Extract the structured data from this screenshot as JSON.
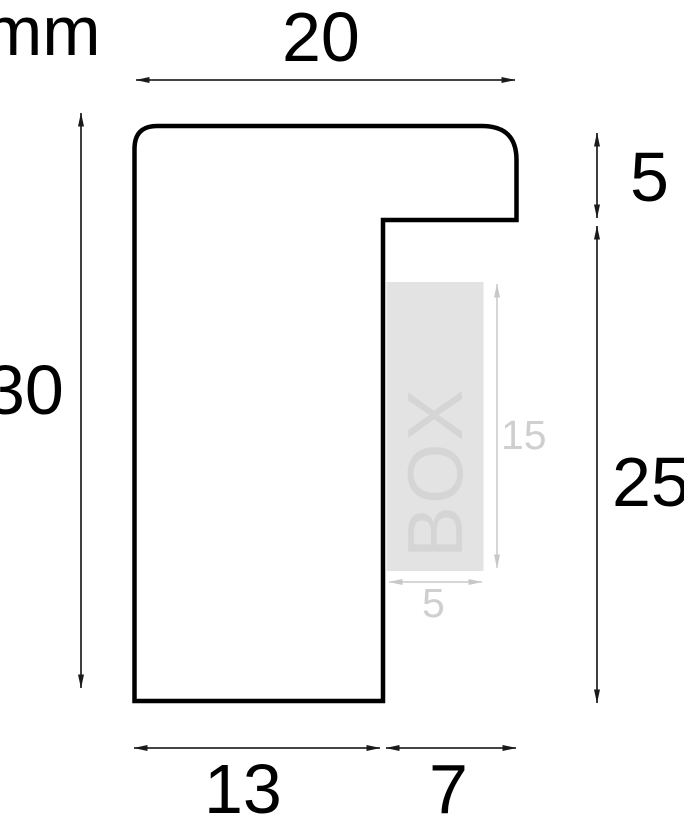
{
  "diagram": {
    "title": "frame-moulding-profile-cross-section",
    "unit": "mm",
    "profile": {
      "total_width_mm": "20",
      "total_height_mm": "30",
      "lip_height_mm": "5",
      "lower_right_height_mm": "25",
      "bottom_left_width_mm": "13",
      "bottom_right_width_mm": "7"
    },
    "insert": {
      "label": "BOX",
      "depth_mm": "15",
      "width_mm": "5"
    },
    "colors": {
      "outline": "#000000",
      "dimension_line": "#2a2a2a",
      "insert_fill": "#e3e3e3",
      "insert_text": "#d5d5d5",
      "gray_dimension": "#c8c8c8",
      "background": "#ffffff"
    }
  }
}
